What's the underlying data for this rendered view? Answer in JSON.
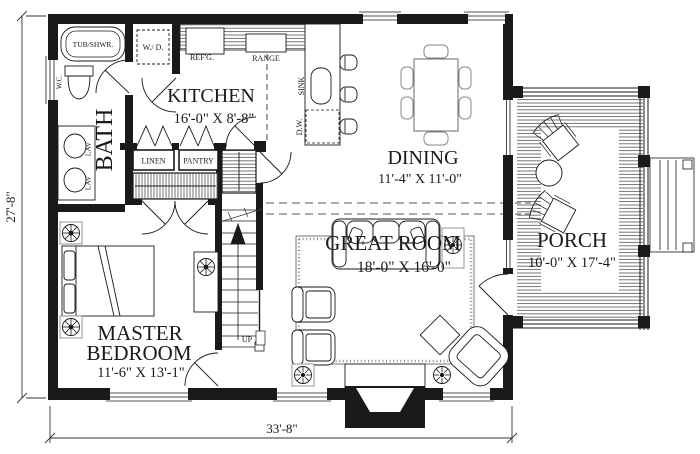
{
  "plan": {
    "title": "first-floor-plan",
    "rooms": {
      "kitchen": {
        "name": "KITCHEN",
        "dims": "16'-0\" X 8'-8\""
      },
      "dining": {
        "name": "DINING",
        "dims": "11'-4\" X 11'-0\""
      },
      "great_room": {
        "name": "GREAT ROOM",
        "dims": "18'-0\" X 16'-0\""
      },
      "master_bedroom": {
        "name_line1": "MASTER",
        "name_line2": "BEDROOM",
        "dims": "11'-6\" X 13'-1\""
      },
      "porch": {
        "name": "PORCH",
        "dims": "10'-0\" X 17'-4\""
      },
      "bath": {
        "name": "BATH"
      }
    },
    "fixtures": {
      "tub": "TUB/SHWR.",
      "wc": "W.C.",
      "lav1": "LAV",
      "lav2": "LAV",
      "washer_dryer": "W./ D.",
      "refrigerator": "REF'G.",
      "range": "RANGE",
      "sink": "SINK",
      "dishwasher": "D.W.",
      "linen": "LINEN",
      "pantry": "PANTRY",
      "stairs_up": "UP"
    },
    "dimensions": {
      "overall_width": "33'-8\"",
      "overall_height": "27'-8\""
    },
    "colors": {
      "ink": "#1a1a1a",
      "paper": "#ffffff"
    }
  }
}
